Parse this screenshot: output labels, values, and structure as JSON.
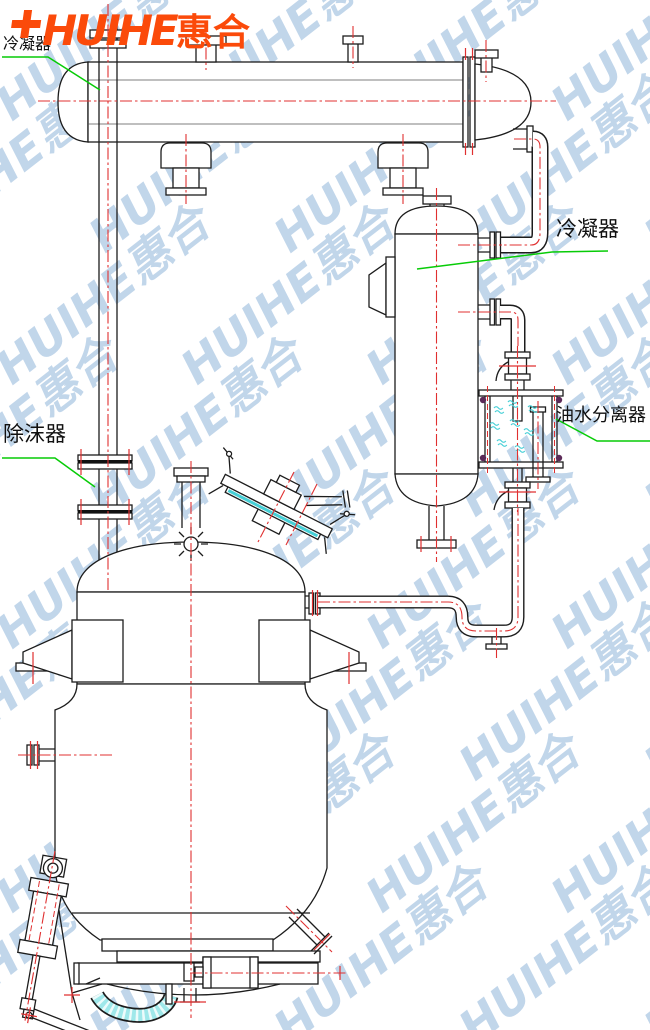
{
  "page": {
    "background": "#ffffff",
    "width": 650,
    "height": 1030
  },
  "logo": {
    "symbol": "plus-mark",
    "latin": "HUIHE",
    "chinese": "惠合",
    "color": "#fb4a0a"
  },
  "watermark": {
    "text": "HUIHE惠合",
    "color": "#6d9ecf"
  },
  "labels": {
    "condenser_top_left": {
      "text": "冷凝器"
    },
    "condenser_right": {
      "text": "冷凝器"
    },
    "demister": {
      "text": "除沫器"
    },
    "oil_water_separator": {
      "text": "油水分离器"
    }
  },
  "colors": {
    "line": "#1c1c1c",
    "centerline": "#e03030",
    "leader": "#07cc07",
    "cyan": "#45cfd6",
    "hose": "#9fe8ea",
    "bolt": "#5c2a58",
    "logo": "#fb4a0a",
    "watermark": "#6d9ecf",
    "label": "#101010"
  }
}
